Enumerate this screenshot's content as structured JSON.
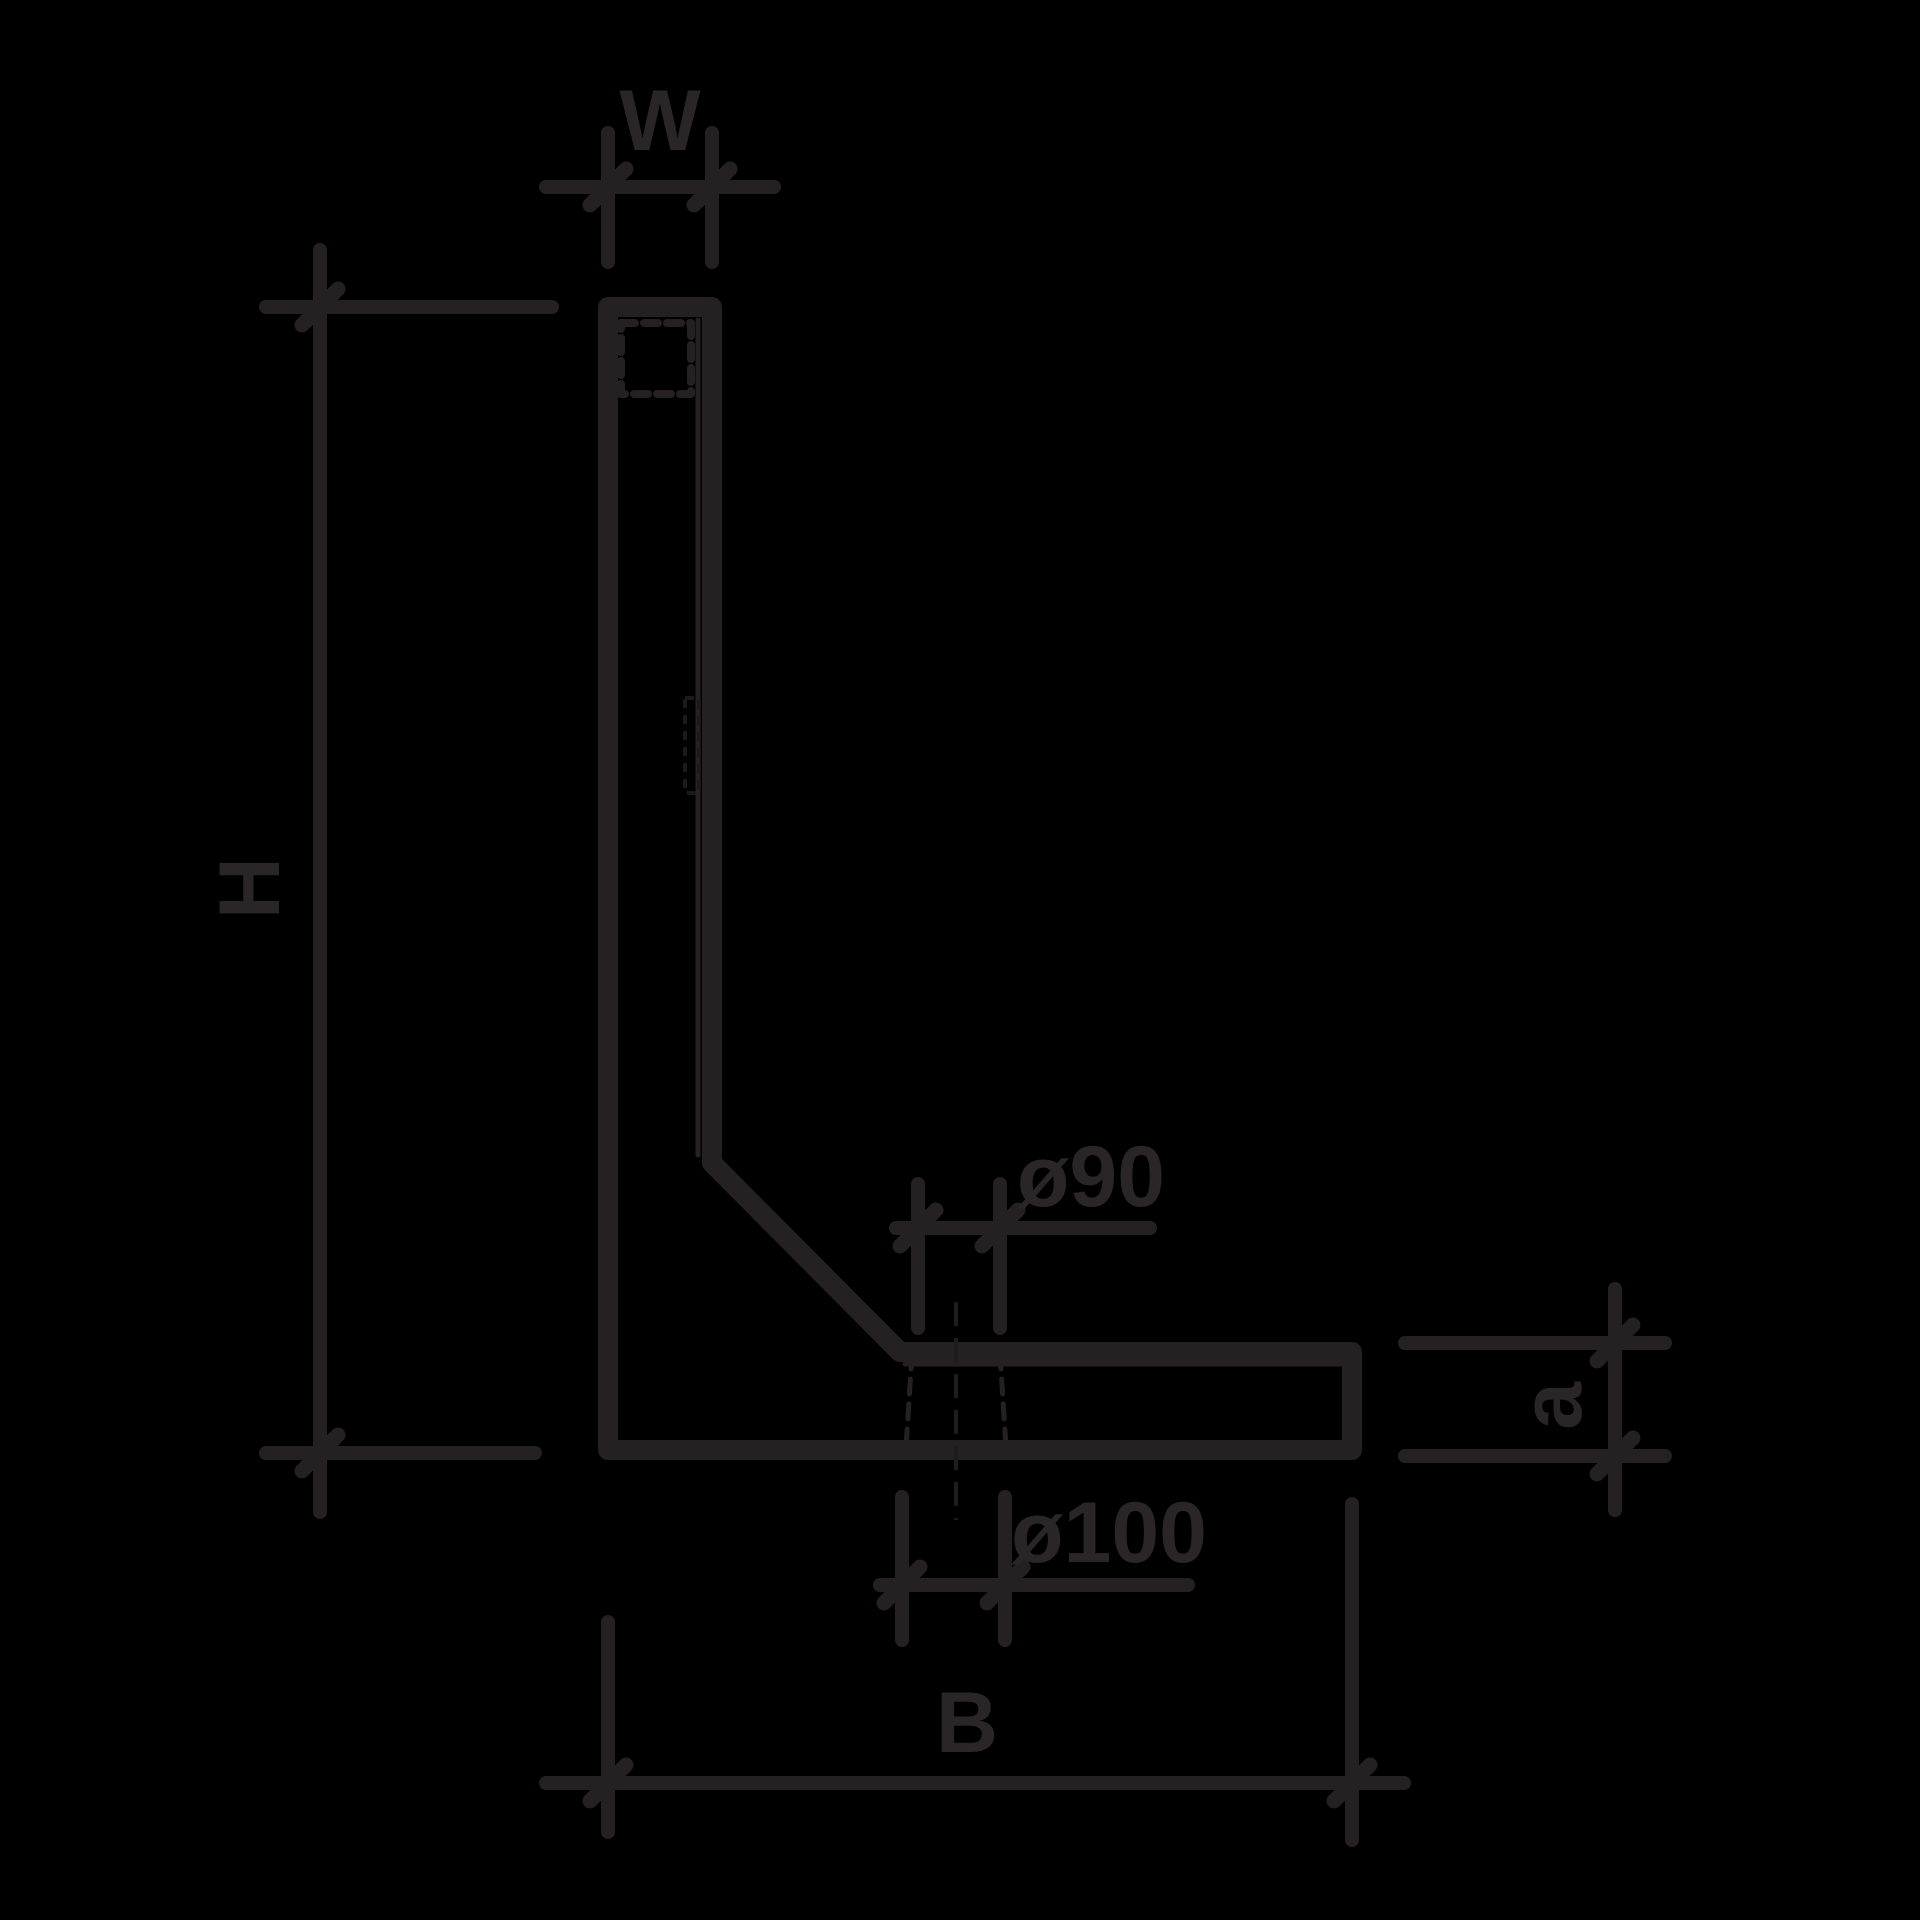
{
  "drawing": {
    "background_color": "#000000",
    "line_color": "#252122",
    "labels": {
      "top_width": "W",
      "height": "H",
      "base_width": "B",
      "base_thickness": "a",
      "hole_upper_diameter": "ø90",
      "hole_lower_diameter": "ø100"
    }
  }
}
